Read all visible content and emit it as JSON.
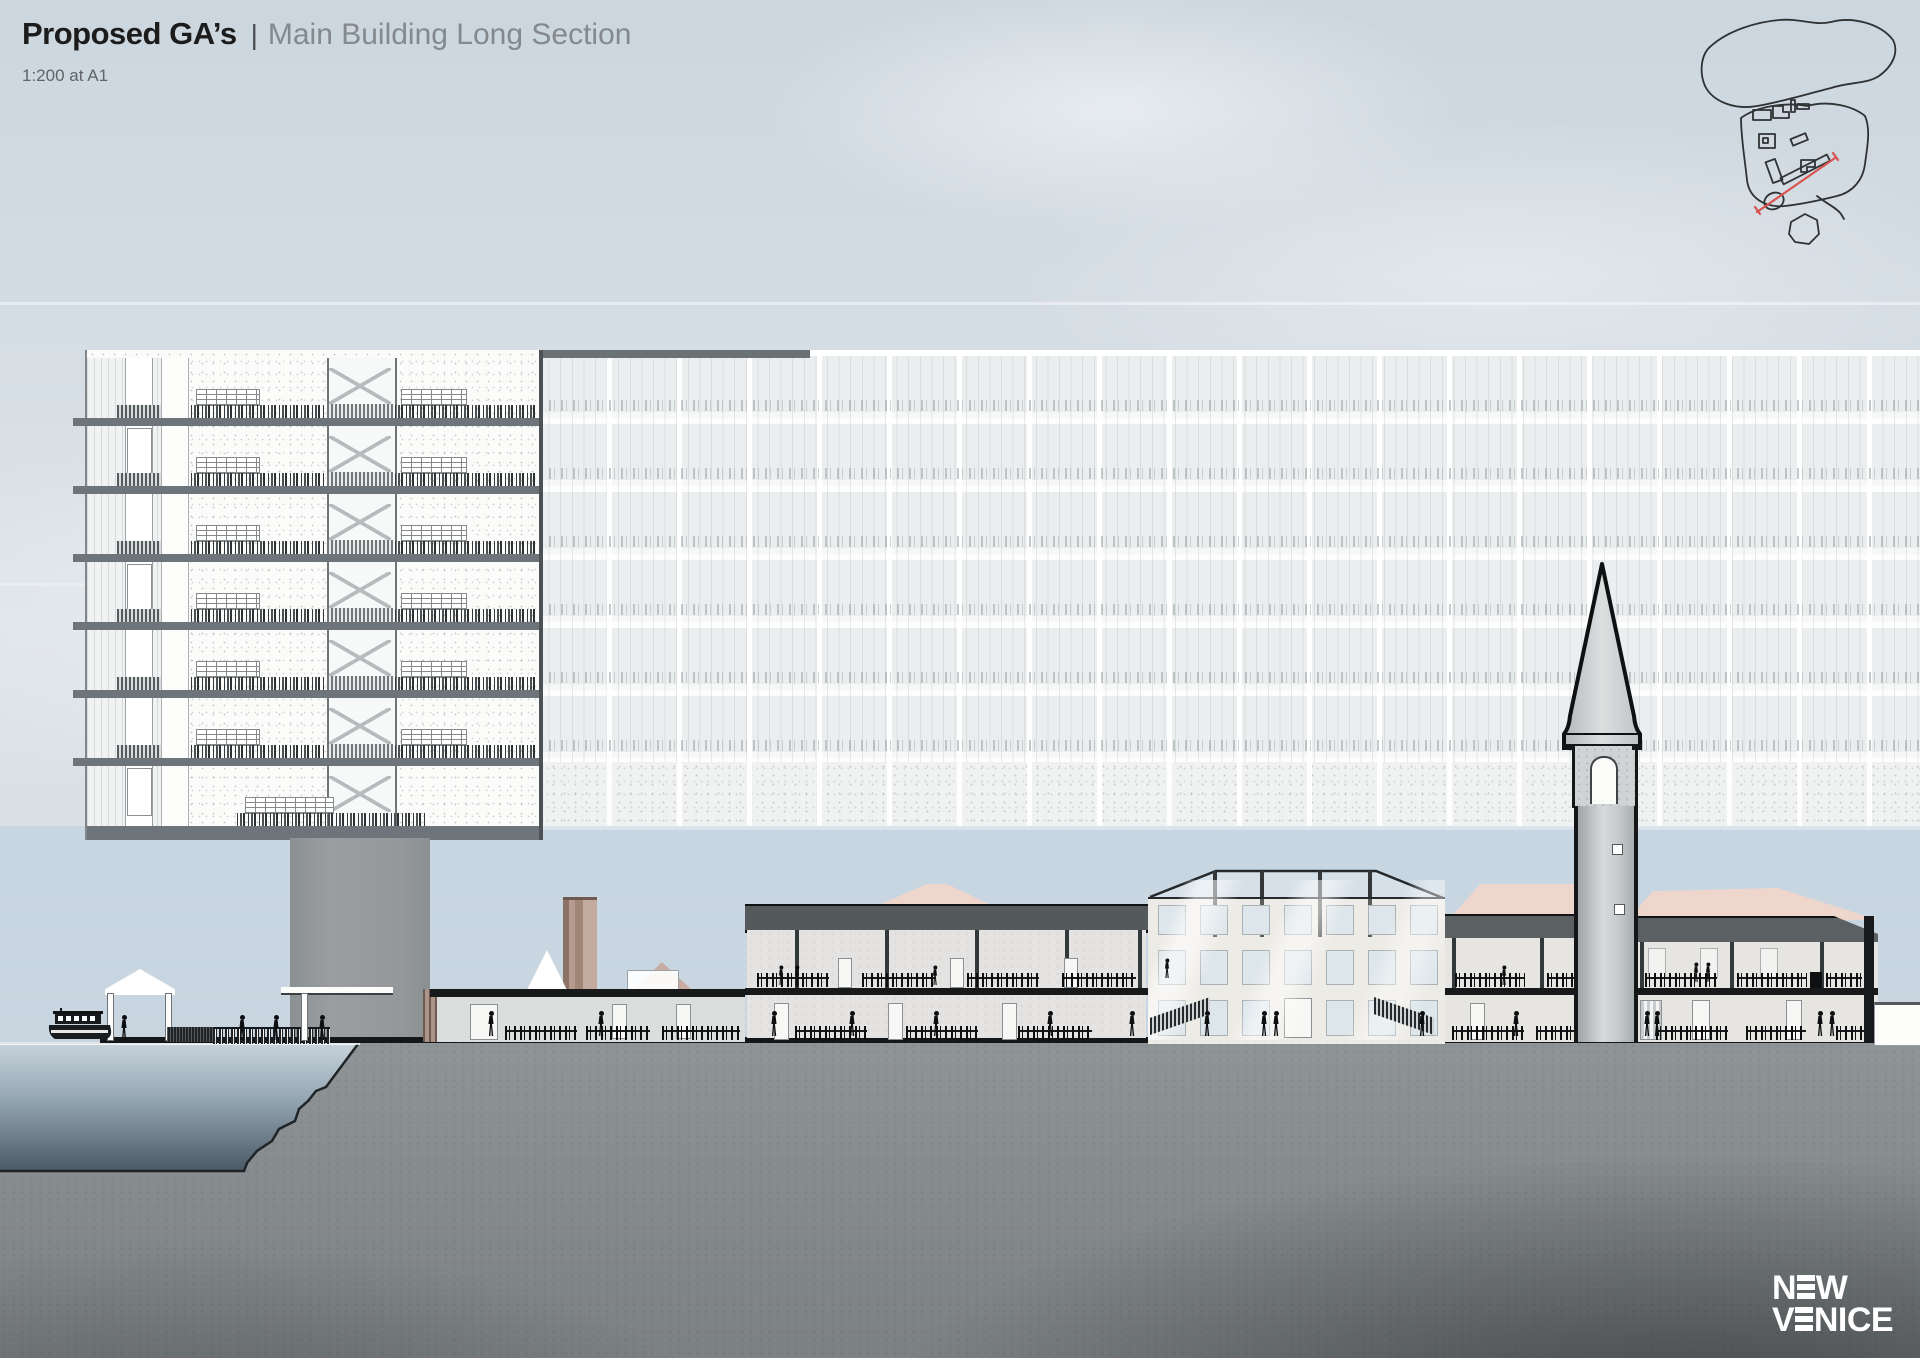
{
  "header": {
    "title_primary": "Proposed GA’s",
    "separator": "|",
    "title_secondary": "Main Building Long Section",
    "scale_note": "1:200 at A1"
  },
  "logo": {
    "word1": "NEW",
    "word2": "VENICE",
    "n_pre": "N",
    "n_post": "W",
    "v_pre": "V",
    "v_post": "NICE"
  },
  "key_plan": {
    "name": "site-key-plan-sketch",
    "section_line_color": "#d9534f",
    "outline_color": "#2f3234"
  },
  "drawing": {
    "type": "architectural long section",
    "elements": [
      "cut tower section",
      "ghosted long elevation",
      "support pillar",
      "vaporetto boat",
      "dock canopy",
      "quay fence",
      "brick chimney",
      "podium building",
      "two-storey colonnade building",
      "central atrium building with glazed roof",
      "connector building",
      "campanile with spire",
      "right colonnade building",
      "water basin section",
      "ground mass section"
    ]
  },
  "colors": {
    "sky_wash": "#d7dfe5",
    "ghost_panel": "#ebeeee",
    "slab_grey": "#6e757a",
    "cut_black": "#17191b",
    "pink_roof": "#eed6cd",
    "brick_chimney": "#b59a8d",
    "water_deep": "#4a5966",
    "earth_grey": "#898e90",
    "logo_white": "#ffffff"
  }
}
